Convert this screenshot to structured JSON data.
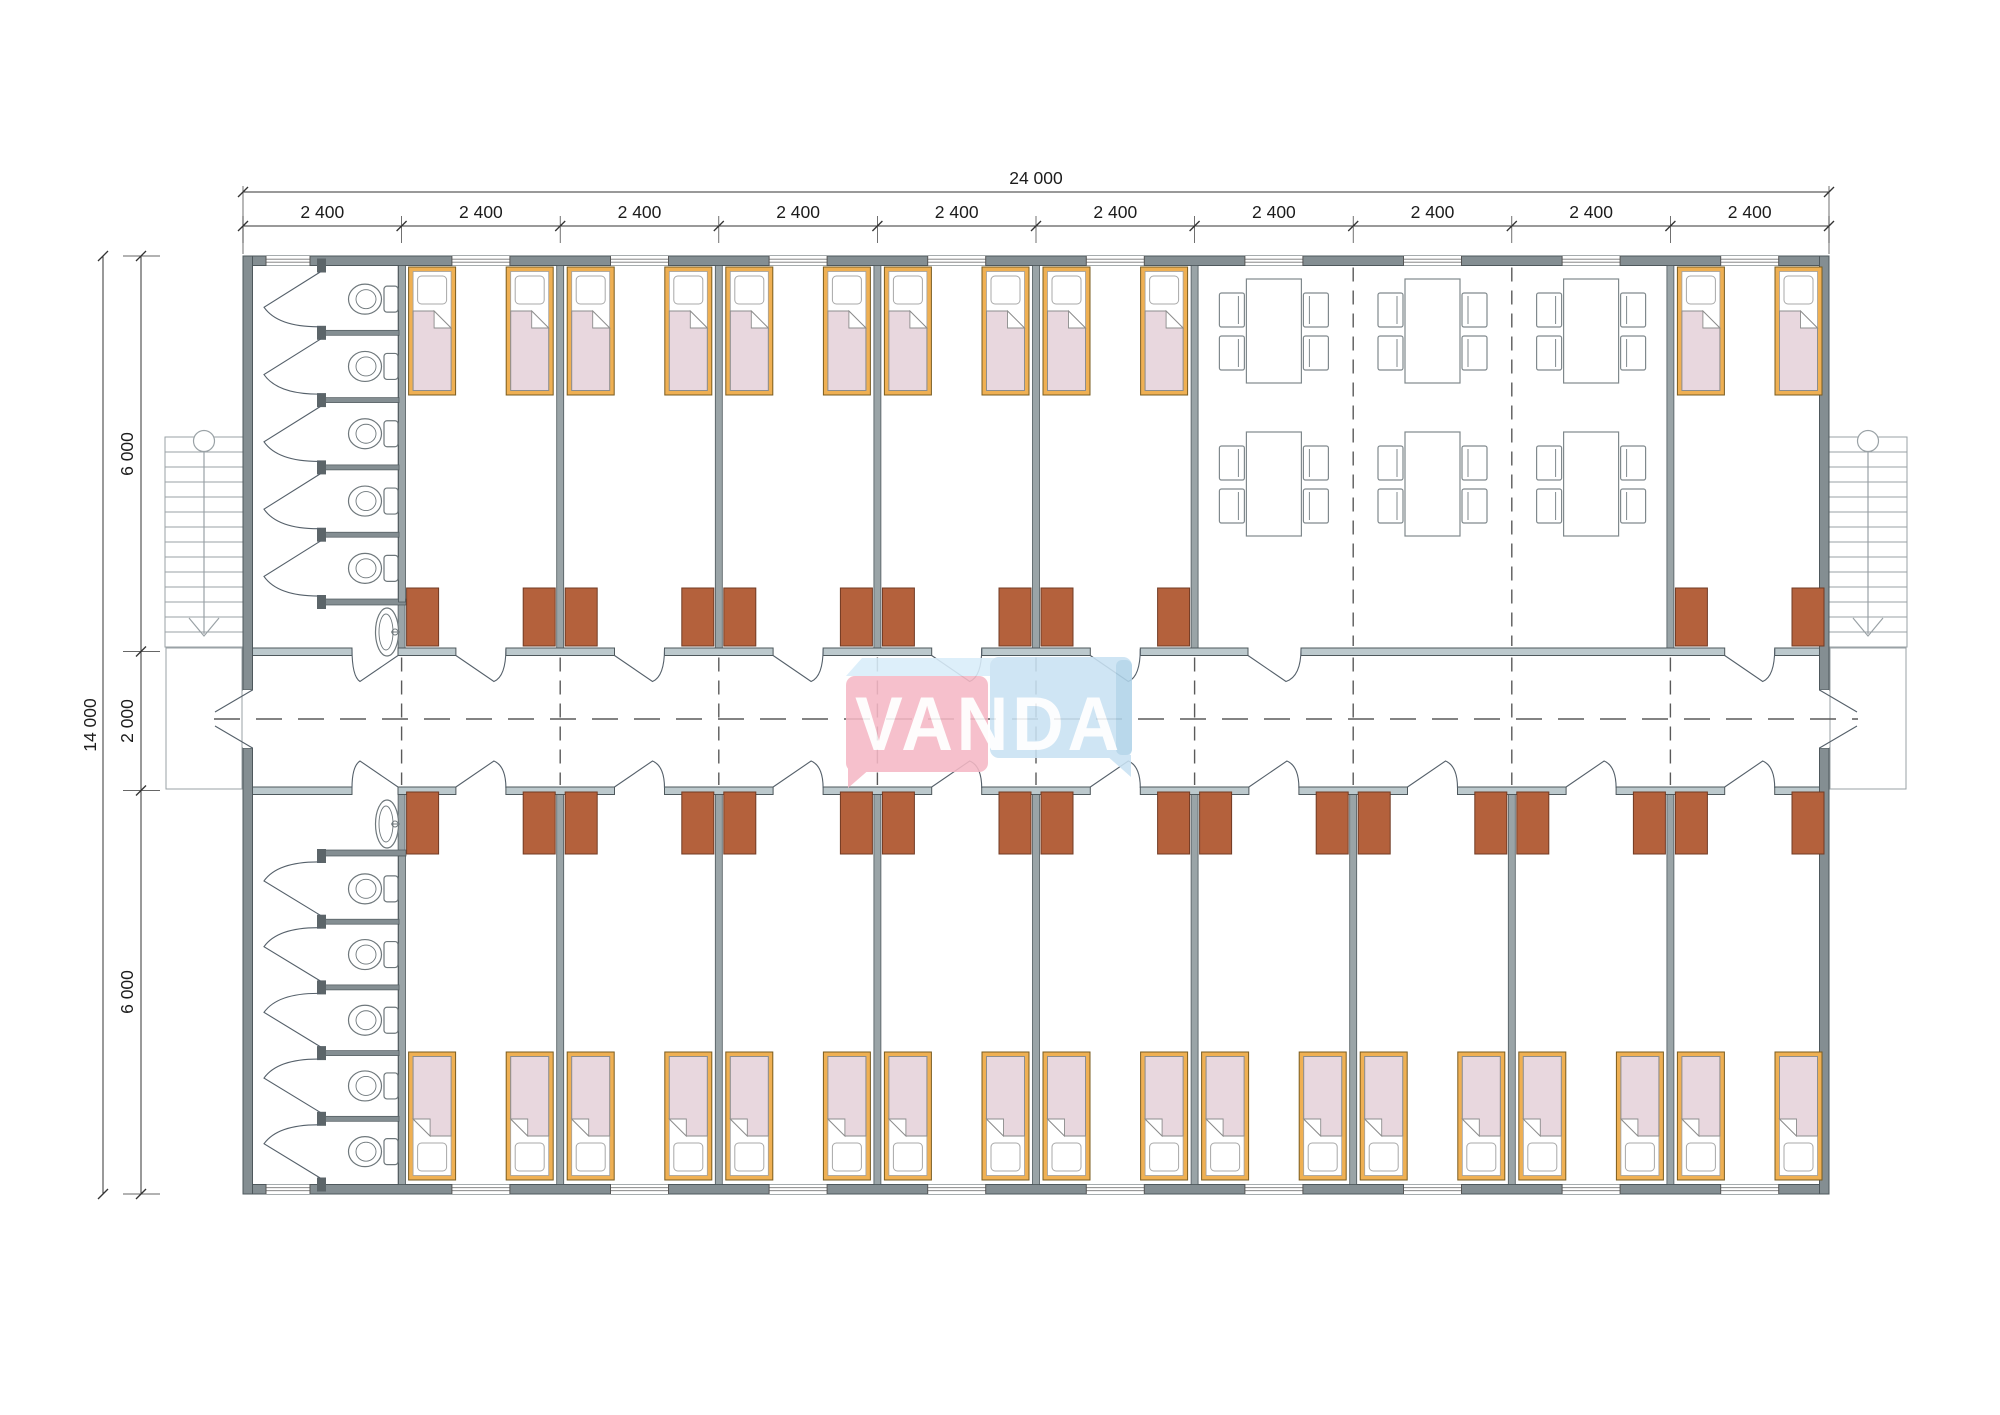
{
  "drawing": {
    "brand": "VANDA",
    "dimensions": {
      "total_width": "24 000",
      "module_width": "2 400",
      "module_count": 10,
      "total_height": "14 000",
      "height_segments": [
        "6 000",
        "2 000",
        "6 000"
      ]
    },
    "rooms": {
      "bedroom_modules_top": 6,
      "bedroom_modules_bottom": 9,
      "beds": 30,
      "wardrobes": 30,
      "bathrooms": 2,
      "toilet_stalls_per_bathroom": 5,
      "sinks_per_bathroom": 1,
      "dining_tables": 6,
      "chairs_per_table": 4,
      "staircases": 2,
      "corridor": 1
    },
    "colors": {
      "wall": "#848e92",
      "wall_edge": "#4e585c",
      "partition": "#9aa4a7",
      "corridor_wall": "#bcc9cd",
      "wardrobe": "#b4613c",
      "wardrobe_edge": "#713b24",
      "bed_frame": "#efb053",
      "bed_frame_edge": "#7a5c20",
      "blanket": "#e8d7de",
      "blanket_edge": "#8d8d8d",
      "fixture_line": "#6e777b",
      "stair_line": "#9aa2a6",
      "dash_line": "#5a5a5a",
      "dim_line": "#333333",
      "dim_text": "#1c1c1c",
      "logo_pink": "#f5b8c5",
      "logo_blue": "#c9e2f3",
      "logo_bevel": "#d9edfa",
      "logo_blue_side": "#b0d3e9",
      "logo_text": "#ffffff"
    }
  }
}
